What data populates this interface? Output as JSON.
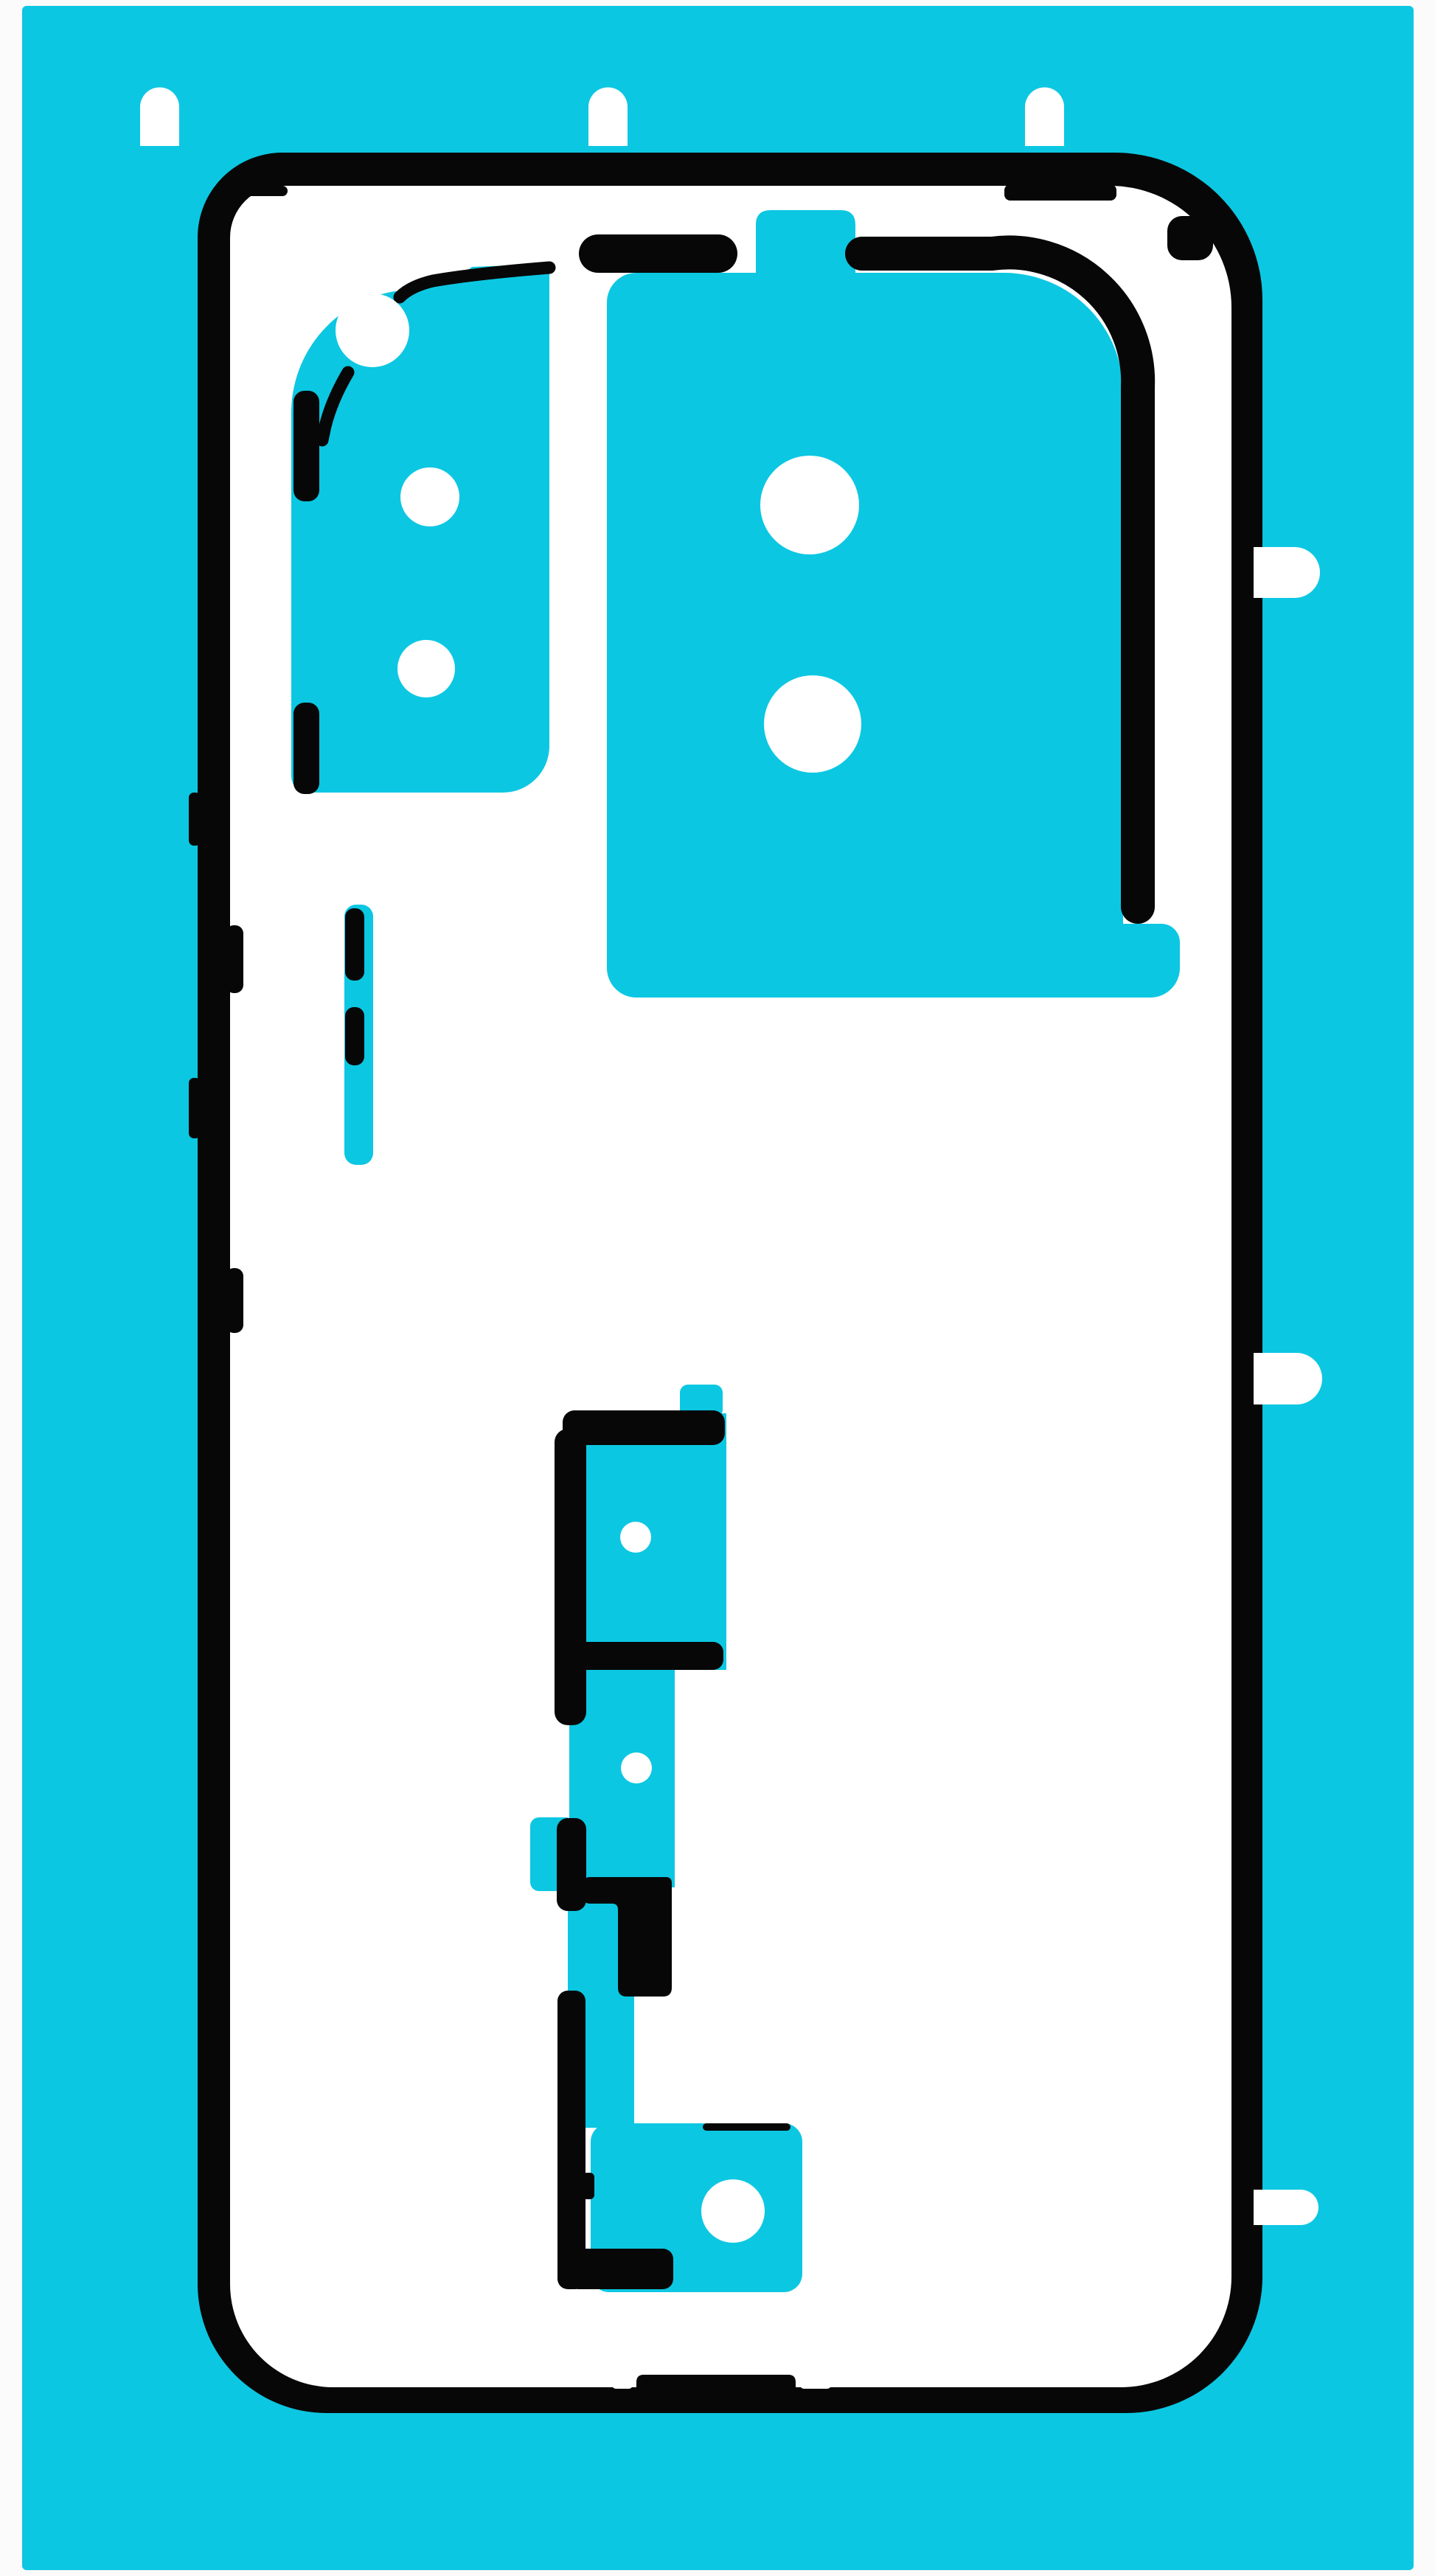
{
  "meta": {
    "description": "Product photo of a phone back-cover adhesive sticker sheet: cyan release liner with black printed cut lines forming a phone outline, camera cut-outs, button strips and pull tabs"
  },
  "colors": {
    "page_bg": "#fbfbfb",
    "sheet_cyan": "#0cc7e2",
    "print_black": "#070707",
    "cutout_white": "#ffffff"
  }
}
